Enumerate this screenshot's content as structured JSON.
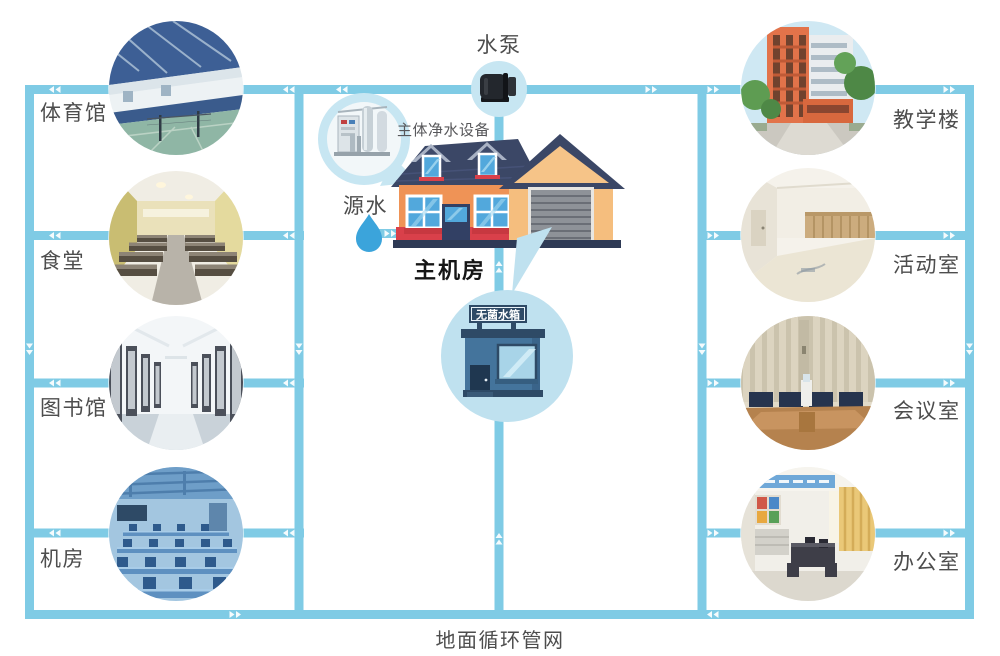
{
  "diagram": {
    "pump": {
      "label": "水泵"
    },
    "purifier": {
      "label": "主体净水设备"
    },
    "source_water": {
      "label": "源水"
    },
    "main_room": {
      "label": "主机房"
    },
    "tank": {
      "sign": "无菌水箱"
    },
    "bottom_label": "地面循环管网",
    "left_facilities": [
      {
        "id": "gymnasium",
        "label": "体育馆"
      },
      {
        "id": "cafeteria",
        "label": "食堂"
      },
      {
        "id": "library",
        "label": "图书馆"
      },
      {
        "id": "server-room",
        "label": "机房"
      }
    ],
    "right_facilities": [
      {
        "id": "teaching-building",
        "label": "教学楼"
      },
      {
        "id": "activity-room",
        "label": "活动室"
      },
      {
        "id": "meeting-room",
        "label": "会议室"
      },
      {
        "id": "office",
        "label": "办公室"
      }
    ],
    "colors": {
      "pipe": "#7FCBE5",
      "bubble": "#C7E6F2",
      "tank_circle": "#BFE1EF",
      "roof": "#3B4766",
      "house_wall": "#EF9356",
      "garage_wall": "#F5BE7E",
      "accent_red": "#D9404A",
      "window_blue": "#52A8DC",
      "tank_wall": "#44749C",
      "water_drop": "#3BA4DB"
    }
  }
}
